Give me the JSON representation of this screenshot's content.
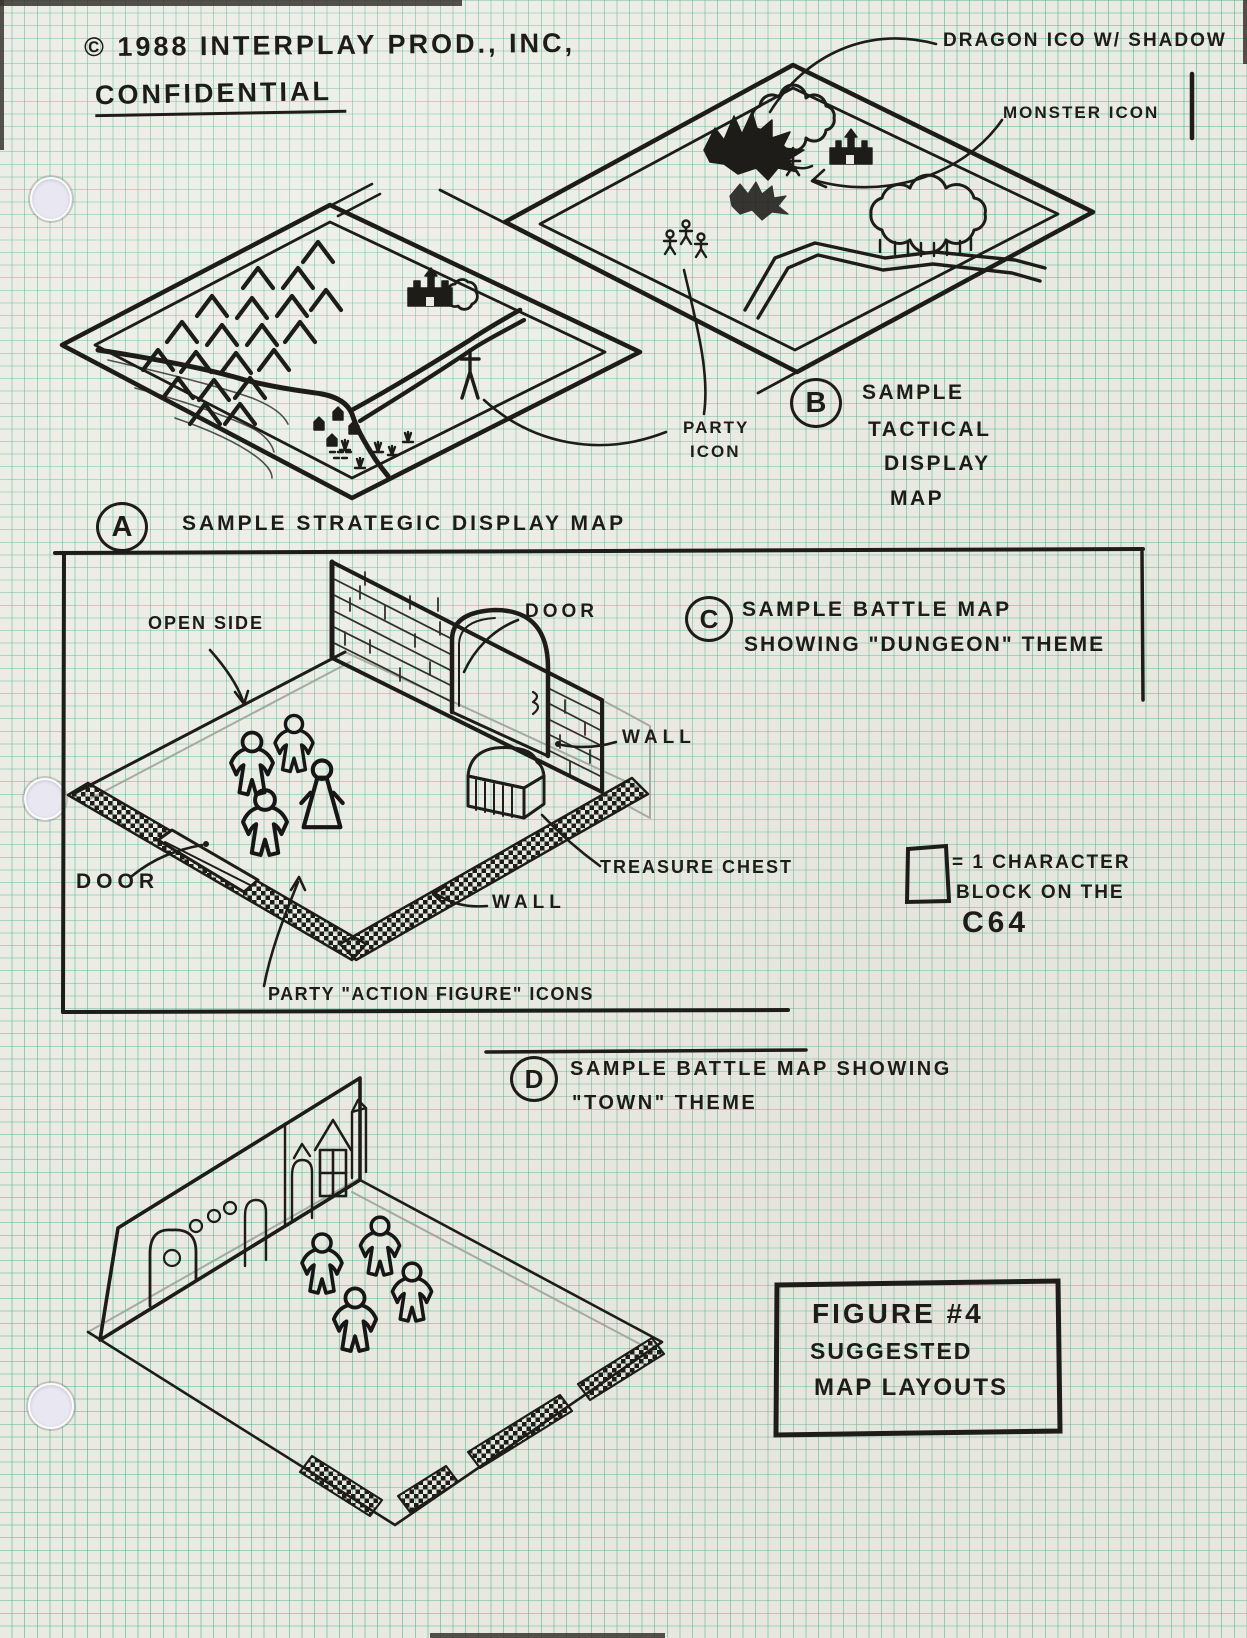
{
  "document": {
    "copyright": "© 1988 INTERPLAY PROD., INC,",
    "confidential": "CONFIDENTIAL"
  },
  "sections": {
    "a": {
      "letter": "A",
      "lines": [
        "SAMPLE STRATEGIC DISPLAY MAP"
      ]
    },
    "b": {
      "letter": "B",
      "lines": [
        "SAMPLE",
        "TACTICAL",
        "DISPLAY",
        "MAP"
      ]
    },
    "c": {
      "letter": "C",
      "lines": [
        "SAMPLE BATTLE MAP",
        "SHOWING \"DUNGEON\" THEME"
      ]
    },
    "d": {
      "letter": "D",
      "lines": [
        "SAMPLE BATTLE MAP SHOWING",
        "\"TOWN\" THEME"
      ]
    }
  },
  "annotations": {
    "dragon_icon": "DRAGON ICO W/ SHADOW",
    "monster_icon": "MONSTER ICON",
    "party_icon_line1": "PARTY",
    "party_icon_line2": "ICON",
    "open_side": "OPEN SIDE",
    "door_upper": "DOOR",
    "wall_right": "WALL",
    "treasure_chest": "TREASURE CHEST",
    "door_lower": "DOOR",
    "wall_lower": "WALL",
    "party_figures": "PARTY \"ACTION FIGURE\" ICONS"
  },
  "legend": {
    "line1": "= 1 CHARACTER",
    "line2": "BLOCK ON THE",
    "line3": "C64"
  },
  "figure_box": {
    "lines": [
      "FIGURE #4",
      "SUGGESTED",
      "MAP LAYOUTS"
    ]
  },
  "colors": {
    "ink": "#1e1c19",
    "grid_line": "#3aa686",
    "paper": "#e9eae1"
  }
}
